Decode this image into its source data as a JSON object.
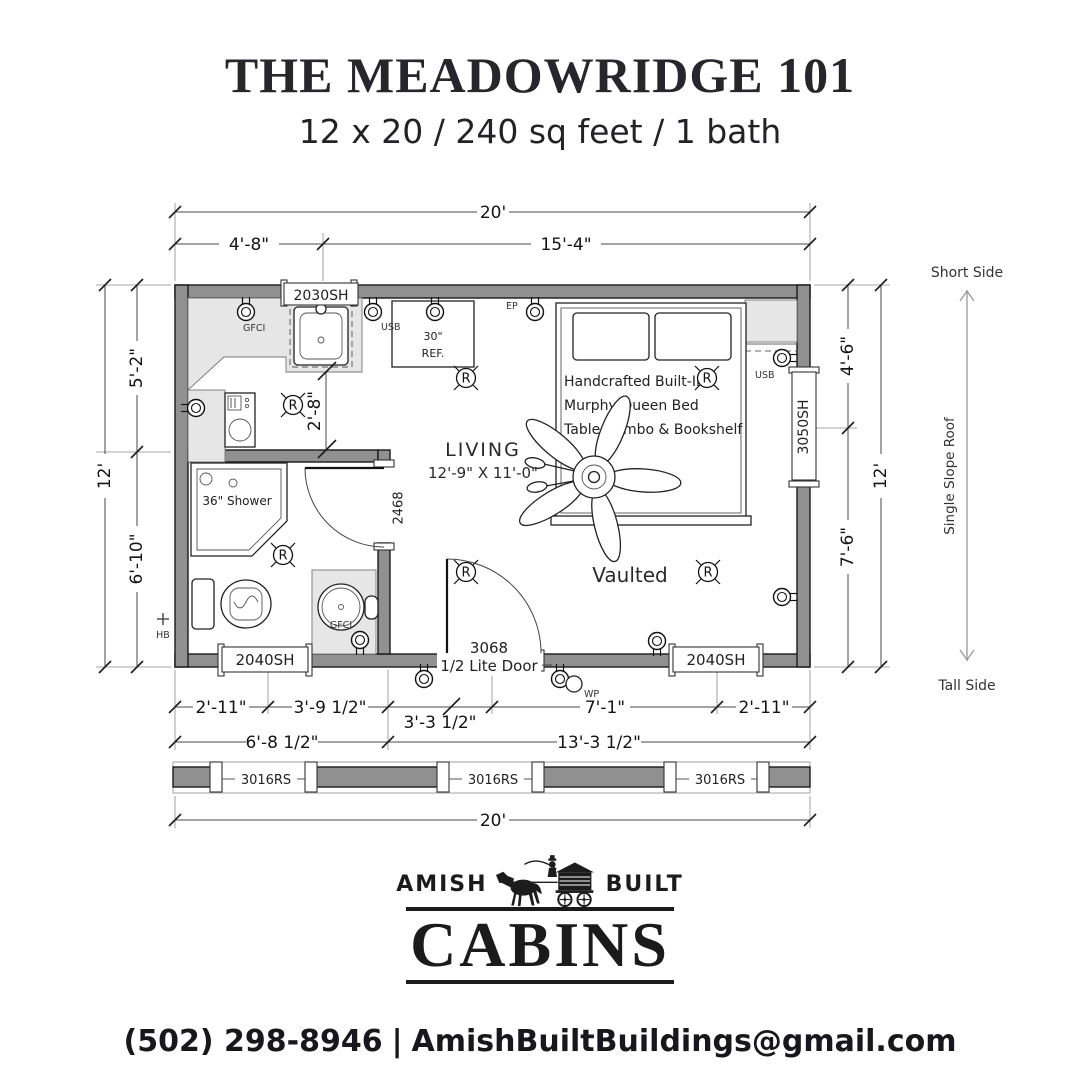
{
  "header": {
    "title": "THE MEADOWRIDGE 101",
    "subtitle": "12 x 20 / 240 sq feet / 1 bath"
  },
  "plan": {
    "dim": {
      "top_total": "20'",
      "top_seg1": "4'-8\"",
      "top_seg2": "15'-4\"",
      "left_total": "12'",
      "left_seg1": "5'-2\"",
      "left_seg2": "6'-10\"",
      "right_seg1": "4'-6\"",
      "right_seg2": "7'-6\"",
      "right_total": "12'",
      "bot_seg1": "2'-11\"",
      "bot_seg2": "3'-9 1/2\"",
      "bot_seg3": "3'-3 1/2\"",
      "bot_seg4": "7'-1\"",
      "bot_seg5": "2'-11\"",
      "bot_sub1": "6'-8 1/2\"",
      "bot_sub2": "13'-3 1/2\"",
      "bot_total": "20'",
      "kitchen_clear": "2'-8\""
    },
    "windows": {
      "top": "2030SH",
      "right": "3050SH",
      "bottom_left": "2040SH",
      "bottom_right": "2040SH",
      "transom": "3016RS"
    },
    "doors": {
      "entry_size": "3068",
      "entry_type": "1/2 Lite Door",
      "bath": "2468"
    },
    "rooms": {
      "living_name": "LIVING",
      "living_size": "12'-9\" X 11'-0\"",
      "ceiling": "Vaulted"
    },
    "fixtures": {
      "bed_line1": "Handcrafted Built-In",
      "bed_line2": "Murphy Queen Bed",
      "bed_line3": "Table Combo & Bookshelf",
      "shower": "36\" Shower",
      "fridge_size": "30\"",
      "fridge": "REF."
    },
    "electrical": {
      "gfci": "GFCI",
      "usb": "USB",
      "ep": "EP",
      "wp": "WP",
      "hb": "HB",
      "recessed": "R"
    },
    "roof": {
      "short": "Short Side",
      "label": "Single Slope Roof",
      "tall": "Tall Side"
    }
  },
  "logo": {
    "word_left": "AMISH",
    "word_right": "BUILT",
    "word_main": "CABINS"
  },
  "footer": {
    "phone": "(502) 298-8946",
    "sep": "|",
    "email": "AmishBuiltBuildings@gmail.com"
  }
}
